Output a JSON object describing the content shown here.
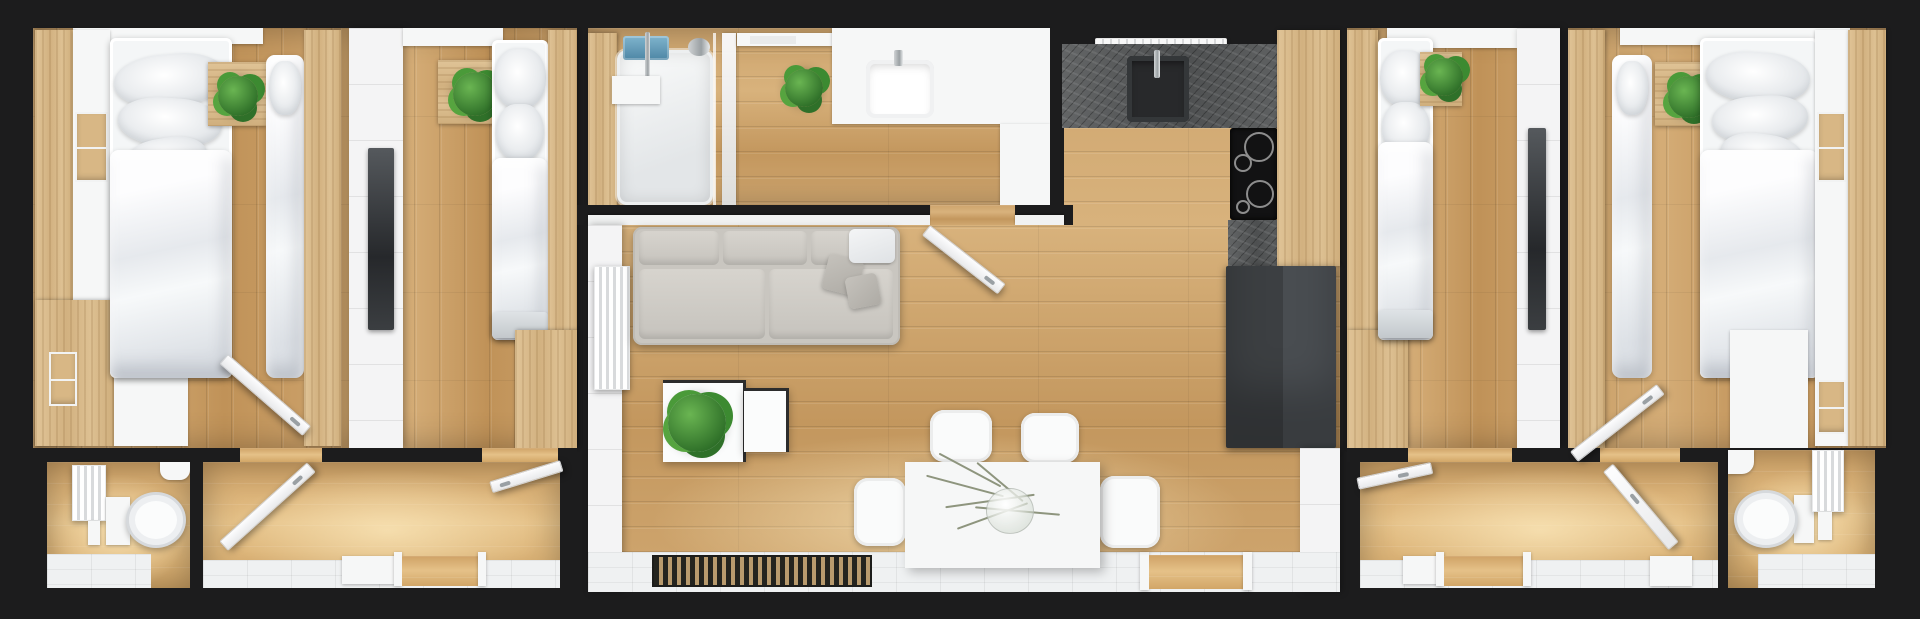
{
  "meta": {
    "title": "Top-down 3D architectural render of a narrow apartment floor plan",
    "view": "orthographic top-down interior render",
    "visible_text": "none"
  },
  "palette": {
    "frame_wall": "#1c1c1d",
    "wood_floor": "#c59a62",
    "wood_floor_warm": "#e5c188",
    "wood_furniture": "#d6b585",
    "wall_white": "#f4f4f5",
    "tile_white": "#eff1f2",
    "stone_counter": "#5a5c5d",
    "appliance_dark": "#45484c",
    "sofa_grey": "#c9c6c0",
    "bedding_white": "#f2f4f6",
    "plant_green": "#3c8a31",
    "towel_blue": "#5b9ab8",
    "tv_panel": "#36393c"
  },
  "rooms": [
    {
      "id": "bedroom-left-outer",
      "name": "Bedroom 1 (far left)",
      "furniture": [
        "oak wardrobe",
        "white shelf unit with oak cubbies",
        "double bed with three pillows",
        "oak bedside table with plant",
        "narrow single bed",
        "white dresser",
        "open door"
      ]
    },
    {
      "id": "bedroom-left-inner",
      "name": "Bedroom 2 (left inner)",
      "furniture": [
        "dark mirror / TV panel",
        "oak bedside table with plant",
        "single bed",
        "oak wardrobe"
      ]
    },
    {
      "id": "bathroom-left",
      "name": "Bathroom (left, WC)",
      "furniture": [
        "white radiator",
        "wall-hung toilet",
        "corner basin",
        "white floor tiles"
      ]
    },
    {
      "id": "hallway-left",
      "name": "Hallway (left)",
      "furniture": [
        "open bathroom door",
        "open bedroom door",
        "entry threshold frames"
      ]
    },
    {
      "id": "bathroom-center",
      "name": "Shower bathroom (center top)",
      "furniture": [
        "walk-in shower with glass screen",
        "chrome shower set",
        "blue towel",
        "potted plant",
        "white vanity with basin",
        "tall white cabinet",
        "open door"
      ]
    },
    {
      "id": "kitchen",
      "name": "Kitchen (center)",
      "furniture": [
        "white extractor hood",
        "dark stone worktop",
        "black sink with faucet",
        "black hob with burners",
        "tall oak column",
        "dark grey fridge unit"
      ]
    },
    {
      "id": "living-dining",
      "name": "Living / dining room (center)",
      "furniture": [
        "white radiator",
        "grey three-seat sofa with cushions and white throw",
        "white nesting coffee tables",
        "fiddle-leaf plant",
        "white dining table with glass vase of dried branches",
        "four white chairs",
        "dark slatted doormat",
        "white tiled entry strip"
      ]
    },
    {
      "id": "bedroom-right-inner",
      "name": "Bedroom 3 (right inner)",
      "furniture": [
        "oak wardrobe",
        "single bed",
        "oak bedside table with plant",
        "dark mirror / TV panel"
      ]
    },
    {
      "id": "bedroom-right-outer",
      "name": "Bedroom 4 (far right)",
      "furniture": [
        "narrow single bed",
        "oak bedside table with plant",
        "double bed with stacked pillows",
        "white dresser",
        "white shelf unit with oak cubbies",
        "oak wardrobe",
        "open door"
      ]
    },
    {
      "id": "hallway-right",
      "name": "Hallway (right)",
      "furniture": [
        "open bedroom door",
        "open bathroom door",
        "entry threshold frames"
      ]
    },
    {
      "id": "bathroom-right",
      "name": "Bathroom (right, WC)",
      "furniture": [
        "corner basin",
        "wall-hung toilet",
        "white radiator",
        "white floor tiles"
      ]
    }
  ]
}
